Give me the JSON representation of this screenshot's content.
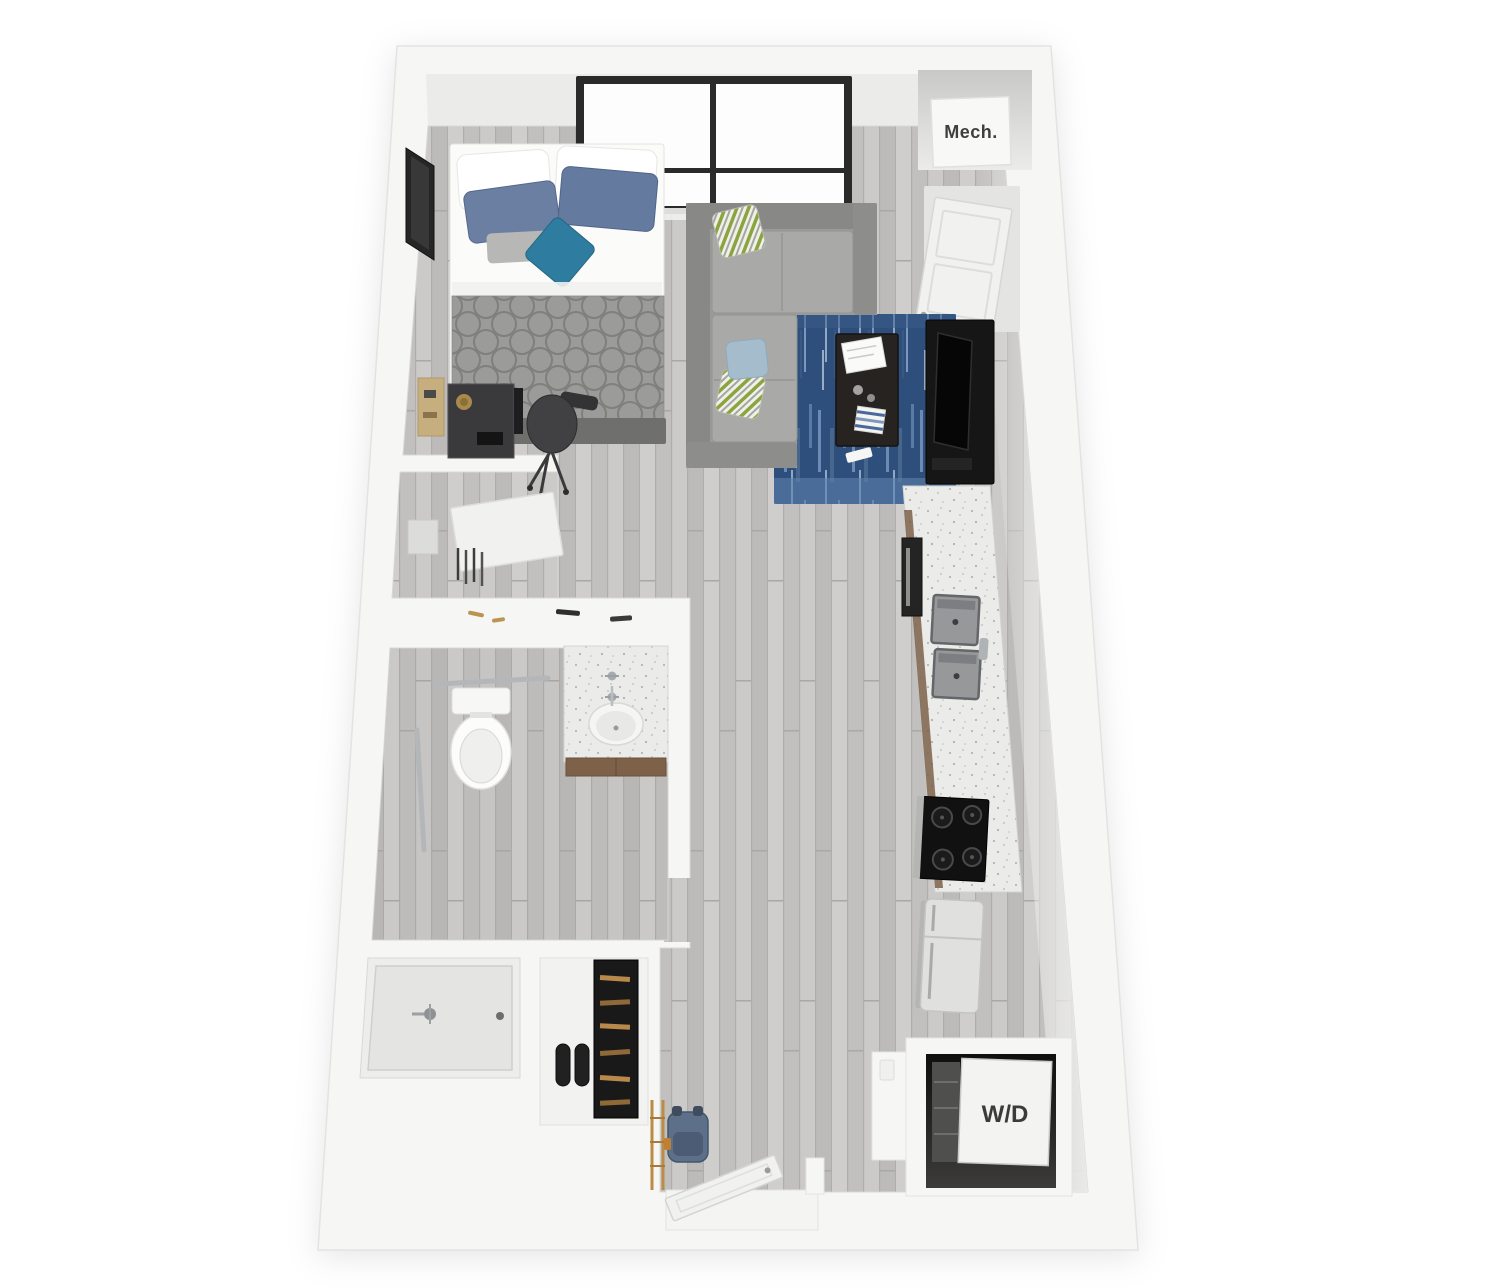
{
  "description": "3D top-down floor plan rendering of a studio apartment",
  "labels": {
    "mechanical_closet": "Mech.",
    "washer_dryer": "W/D"
  },
  "palette": {
    "background": "#ffffff",
    "wall": "#f6f6f5",
    "wall_edge": "#e3e3e1",
    "floor_wood": "#c7c6c4",
    "rug_navy": "#2e4e7c",
    "sofa_gray": "#9a9a98",
    "comforter_gray": "#9b9b99",
    "denim_pillow": "#6b7fa3",
    "accent_pillow_teal": "#2e7ca0",
    "green_stripe_pillow": "#8ba43f",
    "appliance_black": "#161616",
    "counter_speckle": "#ebebe9",
    "cabinet_wood": "#7d6249",
    "window_frame": "#2a2a2a",
    "label_text": "#3f3f3f"
  }
}
